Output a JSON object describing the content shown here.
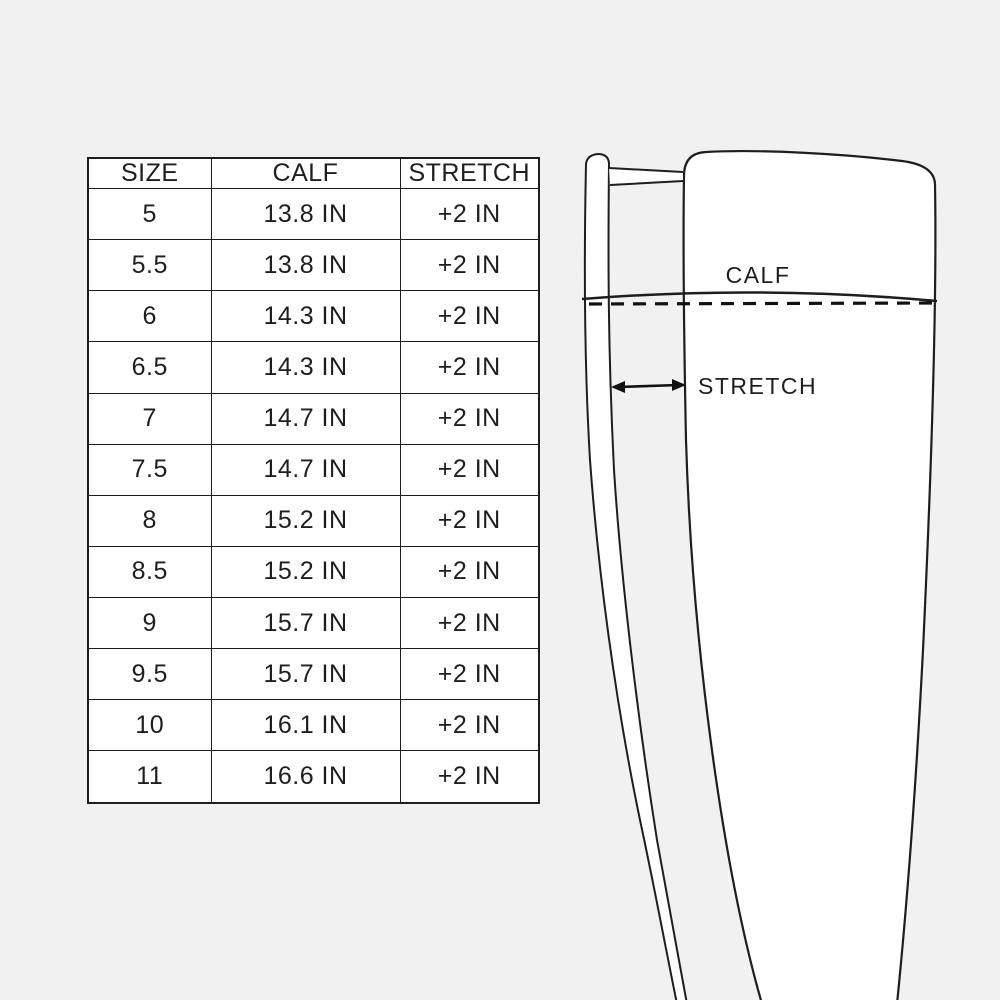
{
  "canvas": {
    "background": "#f1f1f2",
    "surface": "#ffffff",
    "ink": "#1e1e1e"
  },
  "size_chart": {
    "columns": [
      "SIZE",
      "CALF",
      "STRETCH"
    ],
    "rows": [
      [
        "5",
        "13.8 IN",
        "+2 IN"
      ],
      [
        "5.5",
        "13.8 IN",
        "+2 IN"
      ],
      [
        "6",
        "14.3 IN",
        "+2 IN"
      ],
      [
        "6.5",
        "14.3 IN",
        "+2 IN"
      ],
      [
        "7",
        "14.7 IN",
        "+2 IN"
      ],
      [
        "7.5",
        "14.7 IN",
        "+2 IN"
      ],
      [
        "8",
        "15.2 IN",
        "+2 IN"
      ],
      [
        "8.5",
        "15.2 IN",
        "+2 IN"
      ],
      [
        "9",
        "15.7 IN",
        "+2 IN"
      ],
      [
        "9.5",
        "15.7 IN",
        "+2 IN"
      ],
      [
        "10",
        "16.1 IN",
        "+2 IN"
      ],
      [
        "11",
        "16.6 IN",
        "+2 IN"
      ]
    ]
  },
  "boot_diagram": {
    "calf_label": "CALF",
    "stretch_label": "STRETCH"
  }
}
